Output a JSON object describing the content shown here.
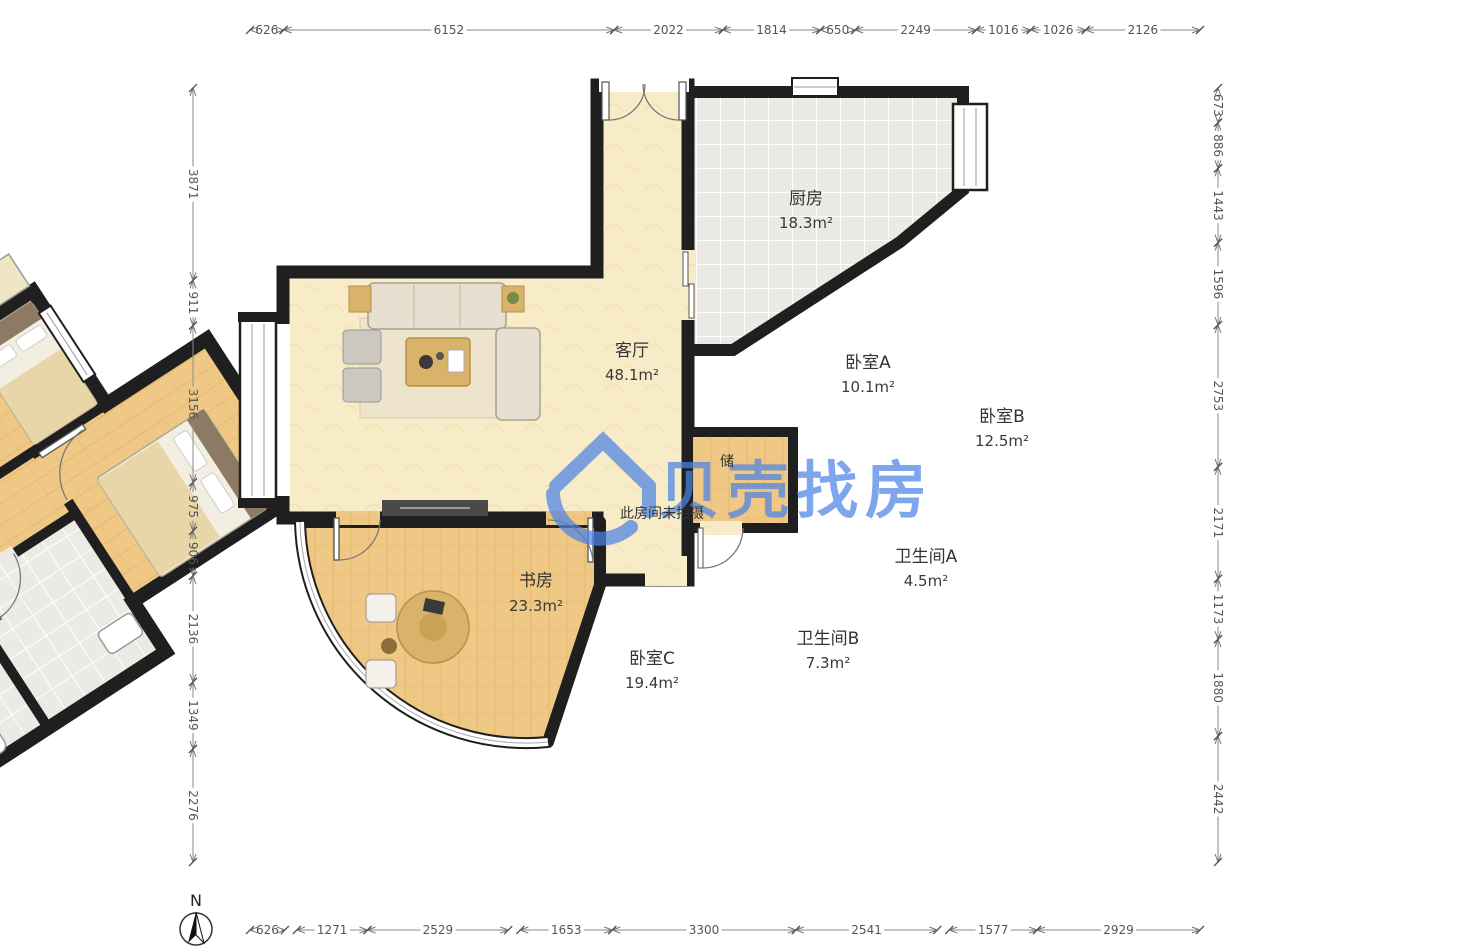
{
  "watermark": {
    "brand": "贝壳找房",
    "color": "#4c84e6"
  },
  "compass": {
    "label": "N"
  },
  "note_unphotographed": "此房间未拍摄",
  "rooms": [
    {
      "id": "living",
      "name": "客厅",
      "area": "48.1m²"
    },
    {
      "id": "kitchen",
      "name": "厨房",
      "area": "18.3m²"
    },
    {
      "id": "bedroomA",
      "name": "卧室A",
      "area": "10.1m²"
    },
    {
      "id": "bedroomB",
      "name": "卧室B",
      "area": "12.5m²"
    },
    {
      "id": "bedroomC",
      "name": "卧室C",
      "area": "19.4m²"
    },
    {
      "id": "study",
      "name": "书房",
      "area": "23.3m²"
    },
    {
      "id": "bathA",
      "name": "卫生间A",
      "area": "4.5m²"
    },
    {
      "id": "bathB",
      "name": "卫生间B",
      "area": "7.3m²"
    },
    {
      "id": "storage",
      "name": "储",
      "area": ""
    }
  ],
  "dimensions": {
    "top": [
      626,
      6152,
      2022,
      1814,
      650,
      2249,
      1016,
      1026,
      2126
    ],
    "bottom": [
      626,
      1271,
      2529,
      1653,
      3300,
      2541,
      1577,
      2929
    ],
    "left": [
      3871,
      911,
      3156,
      975,
      906,
      2136,
      1349,
      2276
    ],
    "right": [
      673,
      886,
      1443,
      1596,
      2753,
      2171,
      1173,
      1880,
      2442
    ]
  },
  "colors": {
    "wall": "#1f1f1f",
    "wood": "#eec884",
    "cream": "#f8ecc8",
    "tile": "#eceae4",
    "watermark_blue": "#4c84e6"
  }
}
